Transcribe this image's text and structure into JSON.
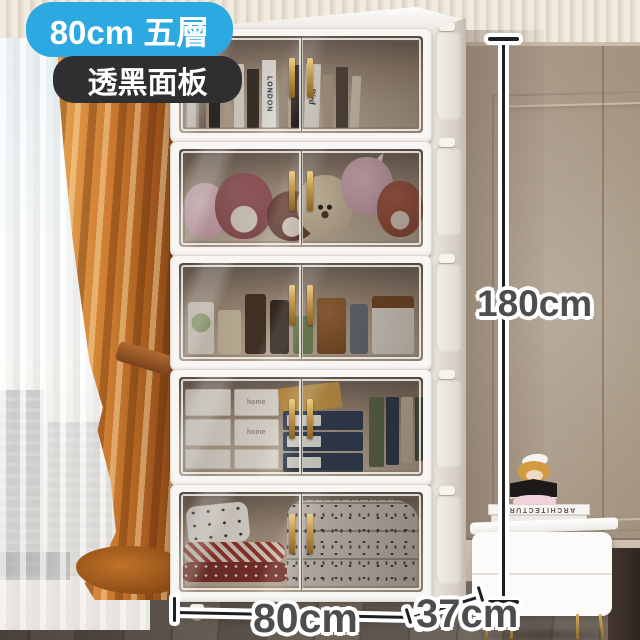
{
  "product_badges": {
    "size": "80cm 五層",
    "panel": "透黑面板"
  },
  "dimension_labels": {
    "height": "180cm",
    "width": "80cm",
    "depth": "37cm"
  },
  "scene": {
    "cabinet_tier_count": 5,
    "cabinet_tiers": [
      {
        "id": 1,
        "contents": "books"
      },
      {
        "id": 2,
        "contents": "plush toys"
      },
      {
        "id": 3,
        "contents": "snack jars and bottles"
      },
      {
        "id": 4,
        "contents": "storage boxes"
      },
      {
        "id": 5,
        "contents": "folded bedding"
      }
    ],
    "visible_text": {
      "book_spine": "LONDON",
      "book_spine_2": "Bird",
      "storage_box": "home",
      "nightstand_book": "ARCHITECTURE"
    }
  },
  "colors": {
    "badge_blue": "#2BA9E0",
    "badge_dark": "#2F2F31",
    "dimension_text": "#4D4D4D",
    "curtain_orange": "#CD7C30",
    "nightstand_accent_orange": "#EF7D1C",
    "handle_gold": "#C69B4E",
    "wall_taupe": "#B2A496"
  }
}
